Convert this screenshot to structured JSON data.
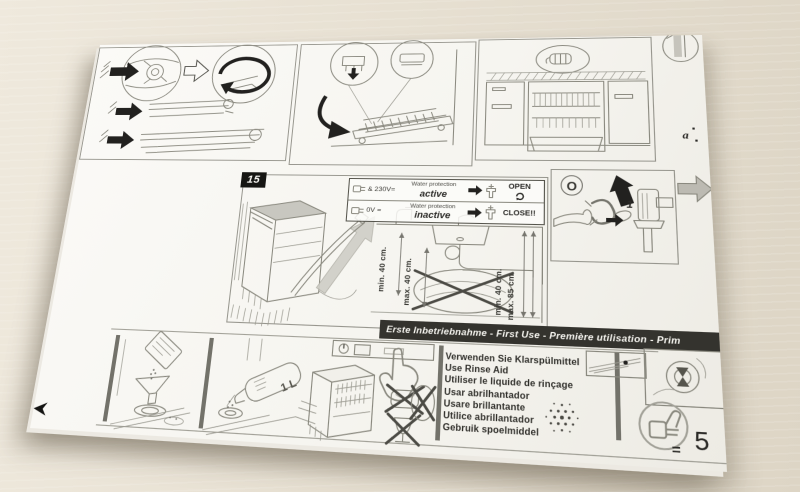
{
  "colors": {
    "background": "#e7e0d2",
    "paper": "#f8f7f3",
    "ink": "#22211f",
    "line_gray": "#8a897f",
    "banner_bg": "#34332e",
    "banner_text": "#f6f5f0"
  },
  "banner": {
    "text": "Erste Inbetriebnahme - First Use - Première utilisation - Prim"
  },
  "step15": {
    "number": "15",
    "water_protection": {
      "rows": [
        {
          "voltage": "& 230V=",
          "label": "Water protection",
          "state": "active",
          "action": "OPEN"
        },
        {
          "voltage": "0V =",
          "label": "Water protection",
          "state": "inactive",
          "action": "CLOSE!!"
        }
      ]
    },
    "dimensions": {
      "left_min": "min. 40 cm.",
      "left_max": "max. 40 cm.",
      "right_min": "min. 40 cm.",
      "right_max": "max. 85 cm."
    }
  },
  "valve_panel": {
    "knob_symbol": "O",
    "step_number": "1"
  },
  "corner_label": "a",
  "rinse_aid": {
    "lines": [
      "Verwenden Sie Klarspülmittel",
      "Use Rinse Aid",
      "Utiliser le liquide de rinçage",
      "Usar abrilhantador",
      "Usare brillantante",
      "Utilice abrillantador",
      "Gebruik spoelmiddel"
    ]
  },
  "salt_fill": {
    "bottle_label": "1 L"
  },
  "footer": {
    "equals": "=",
    "page_number": "5"
  }
}
